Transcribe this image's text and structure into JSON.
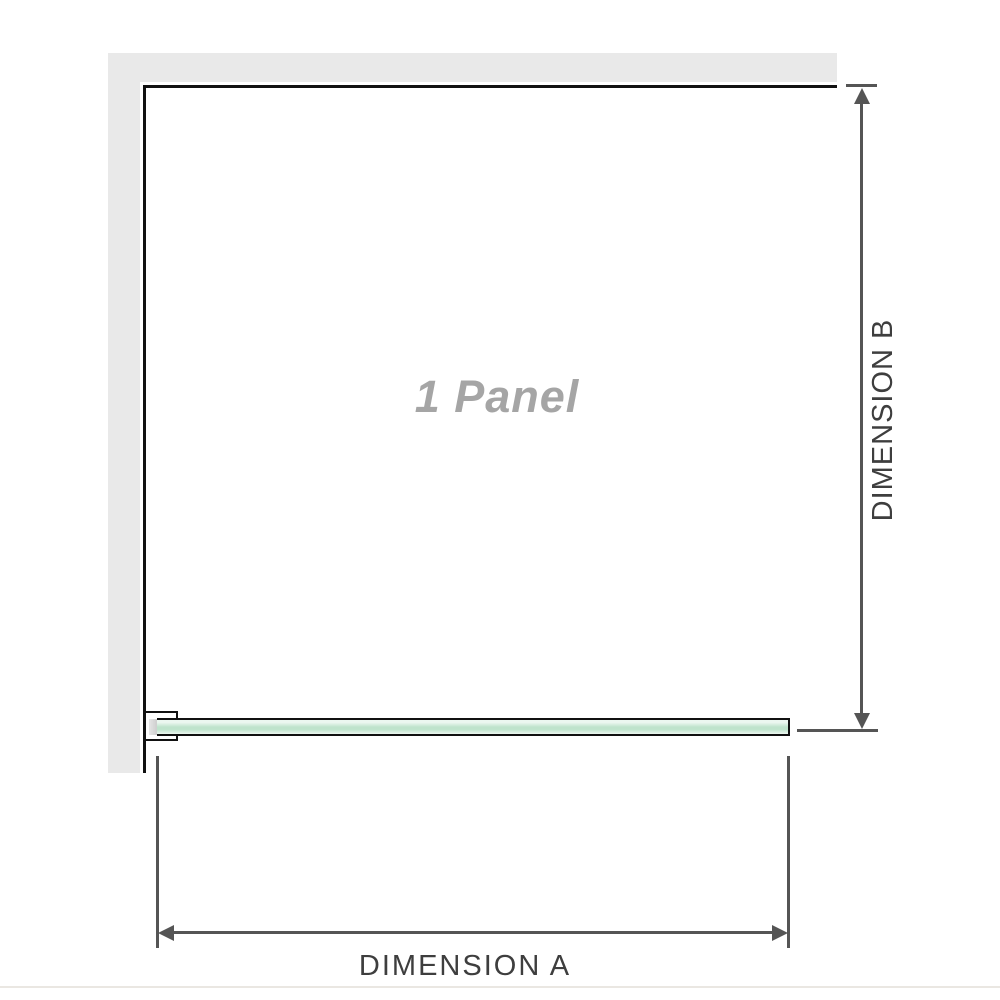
{
  "diagram": {
    "panel_label": "1 Panel",
    "dimension_a_label": "DIMENSION A",
    "dimension_b_label": "DIMENSION B"
  },
  "colors": {
    "background": "#ffffff",
    "wall": "#e9e9e9",
    "outline": "#111111",
    "dimension": "#555555",
    "label_text": "#3e3e3e",
    "panel_label_text": "#a5a5a5",
    "glass_light": "#ecf7f0",
    "glass_mid": "#bfe3cc",
    "bracket_inner": "#c8c8c8",
    "baseline": "#eae7e2"
  }
}
